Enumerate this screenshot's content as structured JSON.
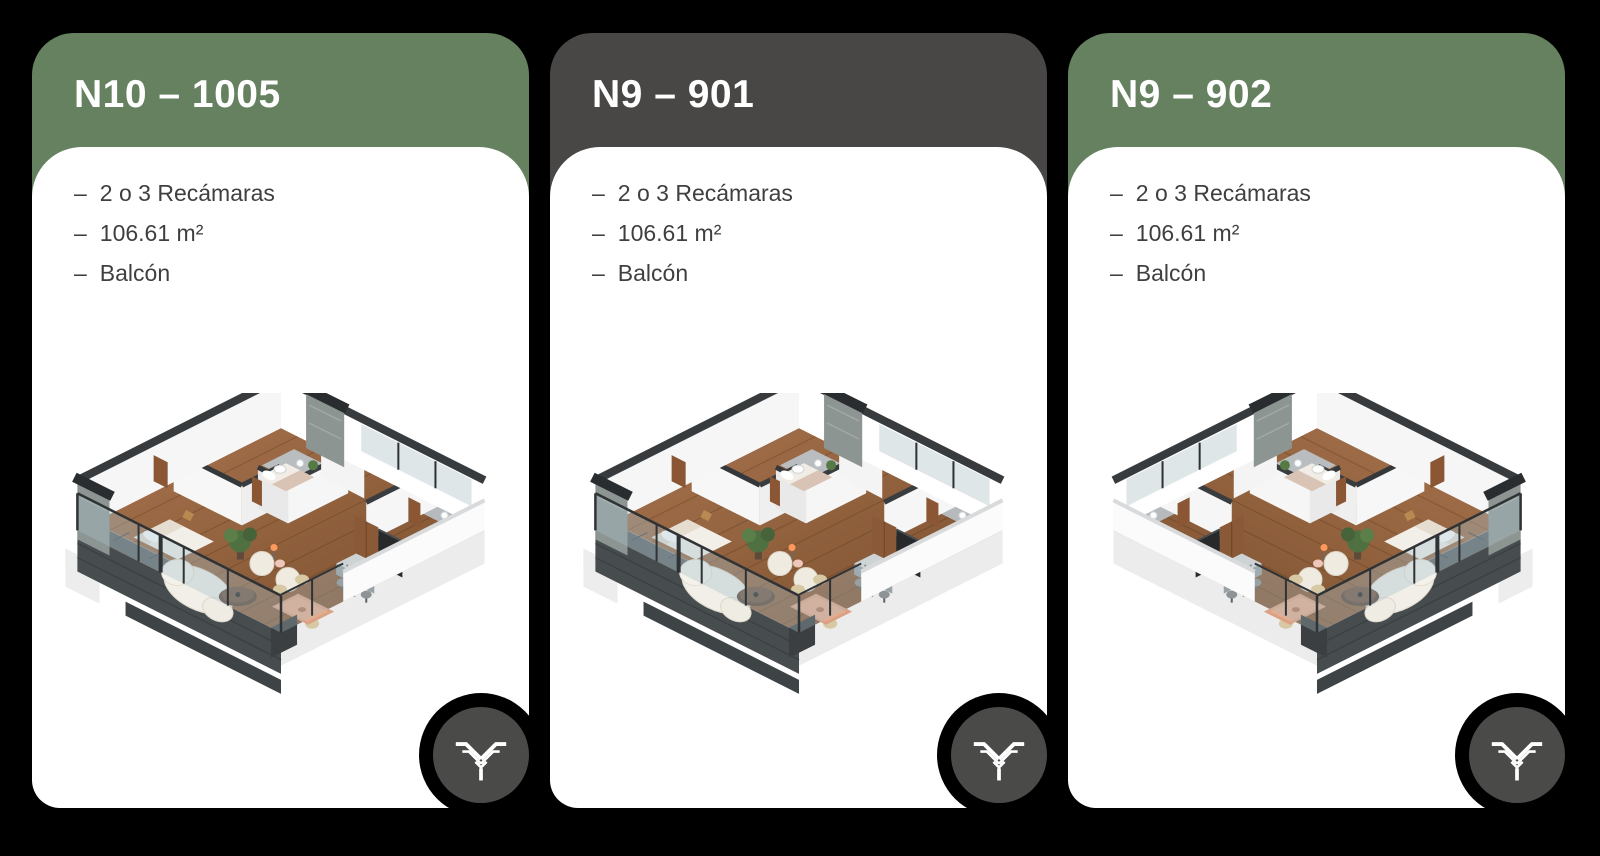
{
  "page": {
    "background": "#000000"
  },
  "colors": {
    "card_body": "#FFFFFF",
    "green_header": "#65815F",
    "dark_header": "#484746",
    "title_text": "#FFFFFF",
    "feature_text": "#3F3F3F",
    "badge_circle": "#4A4A49",
    "badge_cut": "#000000",
    "logo_glyph": "#FFFFFF"
  },
  "bullet": "–",
  "cards": [
    {
      "title": "N10 – 1005",
      "header_color": "#65815F",
      "features": [
        "2 o 3 Recámaras",
        "106.61 m²",
        "Balcón"
      ],
      "floor_plan": "isometric-apartment-render",
      "mirrored": false
    },
    {
      "title": "N9 – 901",
      "header_color": "#484746",
      "features": [
        "2 o 3 Recámaras",
        "106.61 m²",
        "Balcón"
      ],
      "floor_plan": "isometric-apartment-render",
      "mirrored": false
    },
    {
      "title": "N9 – 902",
      "header_color": "#65815F",
      "features": [
        "2 o 3 Recámaras",
        "106.61 m²",
        "Balcón"
      ],
      "floor_plan": "isometric-apartment-render-mirrored",
      "mirrored": true
    }
  ],
  "badge": {
    "icon": "brand-wings-logo"
  }
}
